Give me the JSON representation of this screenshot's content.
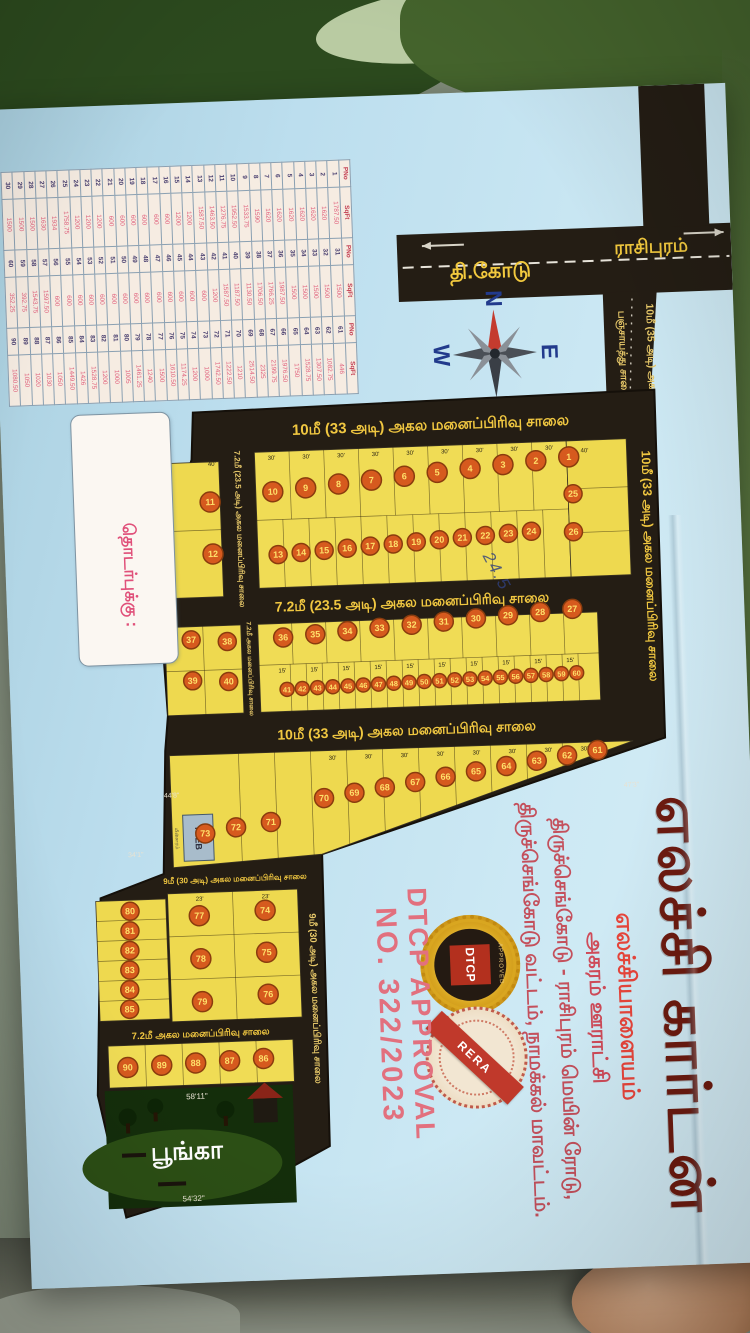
{
  "document": {
    "title": "எலச்சி கார்டன்",
    "subtitle": "எலச்சியாளையம்",
    "address_lines": {
      "line1": "அகரம் ஊராட்சி",
      "line2": "திருச்செங்கோடு - ராசிபுரம் மெயின் ரோடு,",
      "line3": "திருச்செங்கோடு வட்டம், நாமக்கல் மாவட்டம்."
    },
    "approval": {
      "line1": "DTCP APPROVAL",
      "line2": "NO. 322/2023",
      "seal_dtcp": "DTCP",
      "seal_dtcp_ring": "APPROVED",
      "seal_rera": "RERA"
    },
    "contact_label": "தொடர்புக்கு :",
    "handwritten_note": "24.5",
    "compass": {
      "n": "N",
      "e": "E",
      "s": "S",
      "w": "W"
    },
    "main_road": {
      "left_label": "தி.கோடு",
      "right_label": "ராசிபுரம்"
    },
    "access_road": {
      "line1": "10மீ (35 அடி) அகல",
      "line2": "பஞ்சாயத்து சாலை"
    },
    "roads": {
      "top": "10மீ (33 அடி) அகல மனைப்பிரிவு சாலை",
      "right": "10மீ (33 அடி) அகல மனைப்பிரிவு சாலை",
      "mid72": "7.2மீ (23.5 அடி) அகல மனைப்பிரிவு சாலை",
      "vert72": "7.2மீ (23.5 அடி) அகல மனைப்பிரிவு சாலை",
      "vert72b": "7.2மீ அகல மனைப்பிரிவு சாலை",
      "mid10": "10மீ (33 அடி) அகல மனைப்பிரிவு சாலை",
      "nine_h": "9மீ (30 அடி) அகல மனைப்பிரிவு சாலை",
      "nine_v": "9மீ (30 அடி) அகல மனைப்பிரிவு சாலை",
      "bottom72": "7.2மீ அகல மனைப்பிரிவு சாலை"
    },
    "park_label": "பூங்கா",
    "tneb_label": "TNEB",
    "tneb_side": "மின்சாரம்",
    "dims": {
      "d30": "30'",
      "d15": "15'",
      "d40": "40'",
      "d23": "23'",
      "park_top": "58'11\"",
      "park_bottom": "54'32\"",
      "b1": "44'8\"",
      "b2": "34'1\"",
      "b3": "47'3\""
    },
    "plot_groups": {
      "row1": [
        1,
        2,
        3,
        4,
        5,
        6,
        7,
        8,
        9,
        10
      ],
      "left_col_top": [
        11,
        12
      ],
      "row2": [
        13,
        14,
        15,
        16,
        17,
        18,
        19,
        20,
        21,
        22,
        23,
        24
      ],
      "right_col_top": [
        25,
        26
      ],
      "rowA": [
        27,
        28,
        29,
        30,
        31,
        32,
        33,
        34,
        35,
        36
      ],
      "left_group_mid": [
        37,
        38,
        39,
        40
      ],
      "rowB": [
        41,
        42,
        43,
        44,
        45,
        46,
        47,
        48,
        49,
        50,
        51,
        52,
        53,
        54,
        55,
        56,
        57,
        58,
        59,
        60
      ],
      "band3": [
        61,
        62,
        63,
        64,
        65,
        66,
        67,
        68,
        69,
        70,
        71,
        72,
        73
      ],
      "leg_grid": [
        74,
        75,
        76,
        77,
        78,
        79
      ],
      "leg_left_col": [
        80,
        81,
        82,
        83,
        84,
        85
      ],
      "bottom_row": [
        86,
        87,
        88,
        89,
        90
      ]
    },
    "table": {
      "headers": [
        "PNo",
        "SqFt",
        "PNo",
        "SqFt",
        "PNo",
        "SqFt"
      ],
      "rows": [
        [
          "1",
          "1787.50",
          "31",
          "1500",
          "61",
          "446"
        ],
        [
          "2",
          "1620",
          "32",
          "1500",
          "62",
          "1082.75"
        ],
        [
          "3",
          "1620",
          "33",
          "1500",
          "63",
          "1307.50"
        ],
        [
          "4",
          "1620",
          "34",
          "1500",
          "64",
          "1528.75"
        ],
        [
          "5",
          "1620",
          "35",
          "1500",
          "65",
          "1750"
        ],
        [
          "6",
          "1620",
          "36",
          "1987.50",
          "66",
          "1976.50"
        ],
        [
          "7",
          "1620",
          "37",
          "1766.25",
          "67",
          "2199.75"
        ],
        [
          "8",
          "1590",
          "38",
          "1706.50",
          "68",
          "2325"
        ],
        [
          "9",
          "1533.75",
          "39",
          "1130.50",
          "69",
          "2514.50"
        ],
        [
          "10",
          "1952.50",
          "40",
          "1187.50",
          "70",
          "1210"
        ],
        [
          "11",
          "1276.75",
          "41",
          "1587.50",
          "71",
          "1222.50"
        ],
        [
          "12",
          "1463.50",
          "42",
          "1200",
          "72",
          "1742.50"
        ],
        [
          "13",
          "1587.50",
          "43",
          "600",
          "73",
          "1000"
        ],
        [
          "14",
          "1200",
          "44",
          "600",
          "74",
          "1200"
        ],
        [
          "15",
          "1200",
          "45",
          "600",
          "75",
          "1174.25"
        ],
        [
          "16",
          "600",
          "46",
          "600",
          "76",
          "1610.50"
        ],
        [
          "17",
          "600",
          "47",
          "600",
          "77",
          "1500"
        ],
        [
          "18",
          "600",
          "48",
          "600",
          "78",
          "1240"
        ],
        [
          "19",
          "600",
          "49",
          "600",
          "79",
          "1461.25"
        ],
        [
          "20",
          "600",
          "50",
          "600",
          "80",
          "1005"
        ],
        [
          "21",
          "600",
          "51",
          "600",
          "81",
          "1000"
        ],
        [
          "22",
          "1200",
          "52",
          "600",
          "82",
          "1200"
        ],
        [
          "23",
          "1200",
          "53",
          "600",
          "83",
          "1528.75"
        ],
        [
          "24",
          "1200",
          "54",
          "600",
          "84",
          "1426"
        ],
        [
          "25",
          "1758.75",
          "55",
          "600",
          "85",
          "1449.50"
        ],
        [
          "26",
          "1934",
          "56",
          "600",
          "86",
          "1050"
        ],
        [
          "27",
          "1630",
          "57",
          "1597.50",
          "87",
          "1030"
        ],
        [
          "28",
          "1500",
          "58",
          "1543.75",
          "88",
          "1020"
        ],
        [
          "29",
          "1500",
          "59",
          "392.75",
          "89",
          "1050"
        ],
        [
          "30",
          "1500",
          "60",
          "352.25",
          "90",
          "1080.50"
        ]
      ]
    }
  }
}
